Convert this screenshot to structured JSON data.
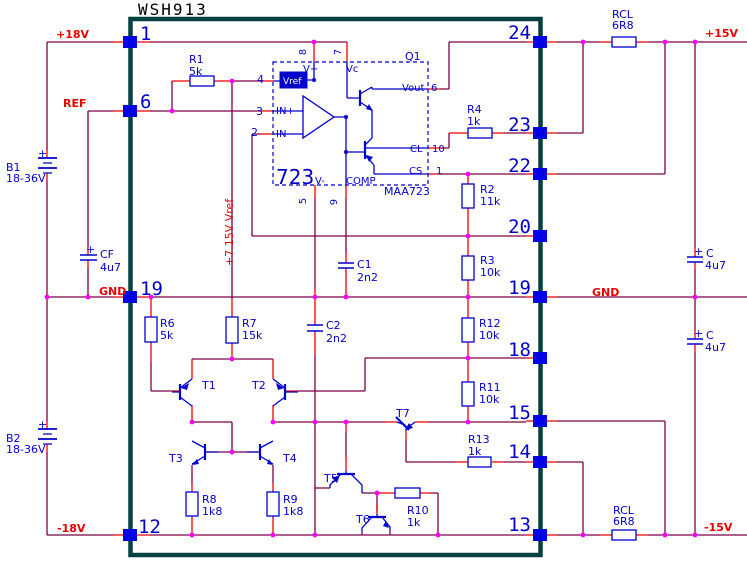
{
  "colors": {
    "wire": "#7b0046",
    "lead": "#f40000",
    "component": "#0000cc",
    "pin_square": "#0000e6",
    "junction": "#ff00ff",
    "module_border": "#004040",
    "label_red": "#e80000",
    "label_blue": "#0000cc",
    "label_black": "#000000",
    "vref_text": "#ffffff",
    "background": "#ffffff"
  },
  "module": {
    "title": "WSH913",
    "left_pins": [
      "1",
      "6",
      "19",
      "12"
    ],
    "right_pins": [
      "24",
      "23",
      "22",
      "20",
      "19",
      "18",
      "15",
      "14",
      "13"
    ]
  },
  "power_rails": [
    "+18V",
    "REF",
    "GND",
    "-18V",
    "+15V",
    "GND",
    "-15V",
    "+7.15V Vref"
  ],
  "ic723": {
    "designator": "723",
    "part": "MAA723",
    "transistor": "Q1",
    "pin_labels": [
      "Vref",
      "IN+",
      "IN-",
      "V+",
      "Vc",
      "Vout",
      "CL",
      "CS",
      "V-",
      "COMP"
    ],
    "pin_numbers": [
      "4",
      "3",
      "2",
      "8",
      "7",
      "6",
      "10",
      "1",
      "5",
      "9"
    ]
  },
  "components": [
    {
      "ref": "B1",
      "value": "18-36V"
    },
    {
      "ref": "B2",
      "value": "18-36V"
    },
    {
      "ref": "CF",
      "value": "4u7"
    },
    {
      "ref": "C",
      "value": "4u7"
    },
    {
      "ref": "C",
      "value": "4u7"
    },
    {
      "ref": "C1",
      "value": "2n2"
    },
    {
      "ref": "C2",
      "value": "2n2"
    },
    {
      "ref": "R1",
      "value": "5k"
    },
    {
      "ref": "R2",
      "value": "11k"
    },
    {
      "ref": "R3",
      "value": "10k"
    },
    {
      "ref": "R4",
      "value": "1k"
    },
    {
      "ref": "R6",
      "value": "5k"
    },
    {
      "ref": "R7",
      "value": "15k"
    },
    {
      "ref": "R8",
      "value": "1k8"
    },
    {
      "ref": "R9",
      "value": "1k8"
    },
    {
      "ref": "R10",
      "value": "1k"
    },
    {
      "ref": "R11",
      "value": "10k"
    },
    {
      "ref": "R12",
      "value": "10k"
    },
    {
      "ref": "R13",
      "value": "1k"
    },
    {
      "ref": "RCL",
      "value": "6R8"
    },
    {
      "ref": "RCL",
      "value": "6R8"
    },
    {
      "ref": "T1"
    },
    {
      "ref": "T2"
    },
    {
      "ref": "T3"
    },
    {
      "ref": "T4"
    },
    {
      "ref": "T5"
    },
    {
      "ref": "T6"
    },
    {
      "ref": "T7"
    }
  ],
  "labels": [
    {
      "n": "title",
      "t": "WSH913",
      "x": 138,
      "y": 15,
      "c": "black",
      "s": 16,
      "f": "mono",
      "ls": 2
    },
    {
      "n": "rail-plus18v",
      "t": "+18V",
      "x": 56,
      "y": 38,
      "c": "red",
      "w": "bold"
    },
    {
      "n": "rail-ref",
      "t": "REF",
      "x": 63,
      "y": 107,
      "c": "red",
      "w": "bold"
    },
    {
      "n": "rail-gnd-left",
      "t": "GND",
      "x": 99,
      "y": 295,
      "c": "red",
      "w": "bold"
    },
    {
      "n": "rail-minus18v",
      "t": "-18V",
      "x": 57,
      "y": 532,
      "c": "red",
      "w": "bold"
    },
    {
      "n": "rail-plus15v",
      "t": "+15V",
      "x": 705,
      "y": 37,
      "c": "red",
      "w": "bold"
    },
    {
      "n": "rail-gnd-right",
      "t": "GND",
      "x": 592,
      "y": 296,
      "c": "red",
      "w": "bold"
    },
    {
      "n": "rail-minus15v",
      "t": "-15V",
      "x": 704,
      "y": 531,
      "c": "red",
      "w": "bold"
    },
    {
      "n": "net-vref-715",
      "t": "+7.15V Vref",
      "x": 233,
      "y": 266,
      "c": "red",
      "r": -90
    },
    {
      "n": "pin-1",
      "t": "1",
      "x": 140,
      "y": 40,
      "c": "blue",
      "s": 19,
      "f": "mono"
    },
    {
      "n": "pin-6",
      "t": "6",
      "x": 140,
      "y": 108,
      "c": "blue",
      "s": 19,
      "f": "mono"
    },
    {
      "n": "pin-19-left",
      "t": "19",
      "x": 140,
      "y": 295,
      "c": "blue",
      "s": 19,
      "f": "mono"
    },
    {
      "n": "pin-12",
      "t": "12",
      "x": 138,
      "y": 533,
      "c": "blue",
      "s": 19,
      "f": "mono"
    },
    {
      "n": "pin-24",
      "t": "24",
      "x": 531,
      "y": 39,
      "c": "blue",
      "s": 19,
      "f": "mono",
      "a": "end"
    },
    {
      "n": "pin-23",
      "t": "23",
      "x": 531,
      "y": 131,
      "c": "blue",
      "s": 19,
      "f": "mono",
      "a": "end"
    },
    {
      "n": "pin-22",
      "t": "22",
      "x": 531,
      "y": 172,
      "c": "blue",
      "s": 19,
      "f": "mono",
      "a": "end"
    },
    {
      "n": "pin-20",
      "t": "20",
      "x": 531,
      "y": 233,
      "c": "blue",
      "s": 19,
      "f": "mono",
      "a": "end"
    },
    {
      "n": "pin-19-right",
      "t": "19",
      "x": 531,
      "y": 294,
      "c": "blue",
      "s": 19,
      "f": "mono",
      "a": "end"
    },
    {
      "n": "pin-18",
      "t": "18",
      "x": 531,
      "y": 356,
      "c": "blue",
      "s": 19,
      "f": "mono",
      "a": "end"
    },
    {
      "n": "pin-15",
      "t": "15",
      "x": 531,
      "y": 419,
      "c": "blue",
      "s": 19,
      "f": "mono",
      "a": "end"
    },
    {
      "n": "pin-14",
      "t": "14",
      "x": 531,
      "y": 458,
      "c": "blue",
      "s": 19,
      "f": "mono",
      "a": "end"
    },
    {
      "n": "pin-13",
      "t": "13",
      "x": 531,
      "y": 531,
      "c": "blue",
      "s": 19,
      "f": "mono",
      "a": "end"
    },
    {
      "n": "ref-R1",
      "t": "R1",
      "x": 189,
      "y": 63,
      "c": "blue"
    },
    {
      "n": "val-R1",
      "t": "5k",
      "x": 189,
      "y": 75,
      "c": "blue"
    },
    {
      "n": "ref-R4",
      "t": "R4",
      "x": 467,
      "y": 113,
      "c": "blue"
    },
    {
      "n": "val-R4",
      "t": "1k",
      "x": 467,
      "y": 125,
      "c": "blue"
    },
    {
      "n": "ref-R2",
      "t": "R2",
      "x": 480,
      "y": 193,
      "c": "blue"
    },
    {
      "n": "val-R2",
      "t": "11k",
      "x": 480,
      "y": 205,
      "c": "blue"
    },
    {
      "n": "ref-R3",
      "t": "R3",
      "x": 480,
      "y": 264,
      "c": "blue"
    },
    {
      "n": "val-R3",
      "t": "10k",
      "x": 480,
      "y": 276,
      "c": "blue"
    },
    {
      "n": "ref-R12",
      "t": "R12",
      "x": 479,
      "y": 327,
      "c": "blue"
    },
    {
      "n": "val-R12",
      "t": "10k",
      "x": 479,
      "y": 339,
      "c": "blue"
    },
    {
      "n": "ref-R11",
      "t": "R11",
      "x": 479,
      "y": 391,
      "c": "blue"
    },
    {
      "n": "val-R11",
      "t": "10k",
      "x": 479,
      "y": 403,
      "c": "blue"
    },
    {
      "n": "ref-R13",
      "t": "R13",
      "x": 468,
      "y": 443,
      "c": "blue"
    },
    {
      "n": "val-R13",
      "t": "1k",
      "x": 468,
      "y": 455,
      "c": "blue"
    },
    {
      "n": "ref-R6",
      "t": "R6",
      "x": 160,
      "y": 327,
      "c": "blue"
    },
    {
      "n": "val-R6",
      "t": "5k",
      "x": 160,
      "y": 339,
      "c": "blue"
    },
    {
      "n": "ref-R7",
      "t": "R7",
      "x": 242,
      "y": 327,
      "c": "blue"
    },
    {
      "n": "val-R7",
      "t": "15k",
      "x": 242,
      "y": 339,
      "c": "blue"
    },
    {
      "n": "ref-R8",
      "t": "R8",
      "x": 202,
      "y": 503,
      "c": "blue"
    },
    {
      "n": "val-R8",
      "t": "1k8",
      "x": 202,
      "y": 515,
      "c": "blue"
    },
    {
      "n": "ref-R9",
      "t": "R9",
      "x": 283,
      "y": 503,
      "c": "blue"
    },
    {
      "n": "val-R9",
      "t": "1k8",
      "x": 283,
      "y": 515,
      "c": "blue"
    },
    {
      "n": "ref-R10",
      "t": "R10",
      "x": 407,
      "y": 514,
      "c": "blue"
    },
    {
      "n": "val-R10",
      "t": "1k",
      "x": 407,
      "y": 526,
      "c": "blue"
    },
    {
      "n": "ref-RCL-top",
      "t": "RCL",
      "x": 612,
      "y": 18,
      "c": "blue"
    },
    {
      "n": "val-RCL-top",
      "t": "6R8",
      "x": 612,
      "y": 29,
      "c": "blue"
    },
    {
      "n": "ref-RCL-bottom",
      "t": "RCL",
      "x": 613,
      "y": 514,
      "c": "blue"
    },
    {
      "n": "val-RCL-bottom",
      "t": "6R8",
      "x": 613,
      "y": 525,
      "c": "blue"
    },
    {
      "n": "ref-C1",
      "t": "C1",
      "x": 357,
      "y": 268,
      "c": "blue"
    },
    {
      "n": "val-C1",
      "t": "2n2",
      "x": 357,
      "y": 281,
      "c": "blue"
    },
    {
      "n": "ref-C2",
      "t": "C2",
      "x": 326,
      "y": 329,
      "c": "blue"
    },
    {
      "n": "val-C2",
      "t": "2n2",
      "x": 326,
      "y": 342,
      "c": "blue"
    },
    {
      "n": "plus-CF",
      "t": "+",
      "x": 86,
      "y": 253,
      "c": "blue"
    },
    {
      "n": "ref-CF",
      "t": "CF",
      "x": 100,
      "y": 258,
      "c": "blue"
    },
    {
      "n": "val-CF",
      "t": "4u7",
      "x": 100,
      "y": 271,
      "c": "blue"
    },
    {
      "n": "plus-C-top",
      "t": "+",
      "x": 694,
      "y": 255,
      "c": "blue"
    },
    {
      "n": "ref-C-top",
      "t": "C",
      "x": 706,
      "y": 257,
      "c": "blue"
    },
    {
      "n": "val-C-top",
      "t": "4u7",
      "x": 705,
      "y": 269,
      "c": "blue"
    },
    {
      "n": "plus-C-bottom",
      "t": "+",
      "x": 694,
      "y": 337,
      "c": "blue"
    },
    {
      "n": "ref-C-bottom",
      "t": "C",
      "x": 706,
      "y": 339,
      "c": "blue"
    },
    {
      "n": "val-C-bottom",
      "t": "4u7",
      "x": 705,
      "y": 351,
      "c": "blue"
    },
    {
      "n": "ref-B1",
      "t": "B1",
      "x": 6,
      "y": 171,
      "c": "blue"
    },
    {
      "n": "val-B1",
      "t": "18-36V",
      "x": 6,
      "y": 182,
      "c": "blue"
    },
    {
      "n": "plus-B1",
      "t": "+",
      "x": 38,
      "y": 157,
      "c": "blue"
    },
    {
      "n": "ref-B2",
      "t": "B2",
      "x": 6,
      "y": 442,
      "c": "blue"
    },
    {
      "n": "val-B2",
      "t": "18-36V",
      "x": 6,
      "y": 453,
      "c": "blue"
    },
    {
      "n": "plus-B2",
      "t": "+",
      "x": 38,
      "y": 428,
      "c": "blue"
    },
    {
      "n": "ref-T1",
      "t": "T1",
      "x": 202,
      "y": 389,
      "c": "blue"
    },
    {
      "n": "ref-T2",
      "t": "T2",
      "x": 252,
      "y": 389,
      "c": "blue"
    },
    {
      "n": "ref-T3",
      "t": "T3",
      "x": 169,
      "y": 462,
      "c": "blue"
    },
    {
      "n": "ref-T4",
      "t": "T4",
      "x": 283,
      "y": 462,
      "c": "blue"
    },
    {
      "n": "ref-T5",
      "t": "T5",
      "x": 324,
      "y": 482,
      "c": "blue"
    },
    {
      "n": "ref-T6",
      "t": "T6",
      "x": 356,
      "y": 523,
      "c": "blue"
    },
    {
      "n": "ref-T7",
      "t": "T7",
      "x": 396,
      "y": 417,
      "c": "blue"
    },
    {
      "n": "ref-Q1",
      "t": "Q1",
      "x": 405,
      "y": 60,
      "c": "blue"
    },
    {
      "n": "ic-pin-4",
      "t": "4",
      "x": 257,
      "y": 83,
      "c": "blue"
    },
    {
      "n": "ic-pin-3",
      "t": "3",
      "x": 256,
      "y": 115,
      "c": "blue"
    },
    {
      "n": "ic-pin-2",
      "t": "2",
      "x": 251,
      "y": 136,
      "c": "blue"
    },
    {
      "n": "ic-in-plus",
      "t": "IN+",
      "x": 276,
      "y": 114,
      "c": "blue",
      "s": 10
    },
    {
      "n": "ic-in-minus",
      "t": "IN-",
      "x": 276,
      "y": 137,
      "c": "blue",
      "s": 10
    },
    {
      "n": "ic-v-plus",
      "t": "V+",
      "x": 303,
      "y": 72,
      "c": "blue",
      "s": 10
    },
    {
      "n": "ic-vc",
      "t": "Vc",
      "x": 346,
      "y": 72,
      "c": "blue",
      "s": 10
    },
    {
      "n": "ic-pin-8",
      "t": "8",
      "x": 306,
      "y": 52,
      "c": "blue",
      "s": 10,
      "r": -90,
      "a": "middle"
    },
    {
      "n": "ic-pin-7",
      "t": "7",
      "x": 341,
      "y": 52,
      "c": "blue",
      "s": 10,
      "r": -90,
      "a": "middle"
    },
    {
      "n": "ic-pin-5",
      "t": "5",
      "x": 306,
      "y": 201,
      "c": "blue",
      "s": 10,
      "r": -90,
      "a": "middle"
    },
    {
      "n": "ic-pin-9",
      "t": "9",
      "x": 337,
      "y": 202,
      "c": "blue",
      "s": 10,
      "r": -90,
      "a": "middle"
    },
    {
      "n": "ic-designator",
      "t": "723",
      "x": 276,
      "y": 184,
      "c": "blue",
      "s": 20
    },
    {
      "n": "ic-v-minus",
      "t": "V-",
      "x": 315,
      "y": 184,
      "c": "blue",
      "s": 10
    },
    {
      "n": "ic-comp",
      "t": "COMP",
      "x": 346,
      "y": 184,
      "c": "blue",
      "s": 10
    },
    {
      "n": "ic-part",
      "t": "MAA723",
      "x": 384,
      "y": 195,
      "c": "blue"
    },
    {
      "n": "ic-vout",
      "t": "Vout",
      "x": 402,
      "y": 91,
      "c": "blue",
      "s": 10
    },
    {
      "n": "ic-pin-6",
      "t": "6",
      "x": 431,
      "y": 91,
      "c": "blue",
      "s": 10
    },
    {
      "n": "ic-cl",
      "t": "CL",
      "x": 410,
      "y": 152,
      "c": "blue",
      "s": 10
    },
    {
      "n": "ic-pin-10",
      "t": "10",
      "x": 432,
      "y": 152,
      "c": "blue",
      "s": 10
    },
    {
      "n": "ic-cs",
      "t": "CS",
      "x": 409,
      "y": 174,
      "c": "blue",
      "s": 10
    },
    {
      "n": "ic-pin-1",
      "t": "1",
      "x": 436,
      "y": 174,
      "c": "blue",
      "s": 10
    },
    {
      "n": "ic-vref",
      "t": "Vref",
      "x": 283,
      "y": 84,
      "c": "white",
      "s": 9
    }
  ]
}
